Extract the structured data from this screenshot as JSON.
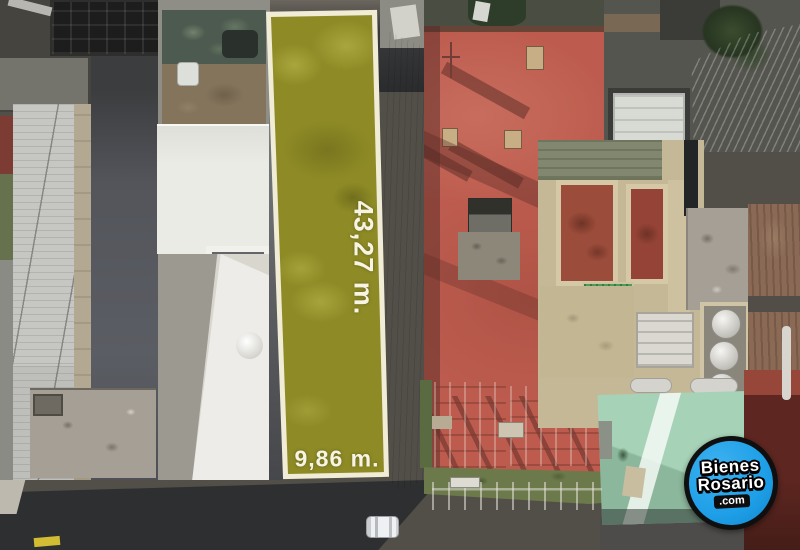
{
  "scene": {
    "description": "Aerial drone photograph of a city block; a long narrow vacant lot is highlighted with a yellow-green overlay between rooftops, street at the bottom",
    "watermark": "BienesRosario.com real-estate badge"
  },
  "lot": {
    "depth_label": "43,27 m.",
    "width_label": "9,86 m."
  },
  "logo": {
    "line1": "Bienes",
    "line2": "Rosario",
    "line3": ".com"
  },
  "colors": {
    "lot_overlay": "#8e8b26",
    "lot_border": "#f1ecd6",
    "measurement_text": "#f7f4e4",
    "logo_blue": "#1e9fe7",
    "logo_ring": "#0f0f0f",
    "logo_text": "#ffffff",
    "red_roof": "#bd5c4e",
    "red_roof_shadow": "#5a2c26",
    "courtyard_red": "#9c4c3a",
    "green_parapet": "#6c7a4b",
    "corrugated_green": "#4f9b58",
    "mint_roof": "#a6d3b7",
    "cream_wall": "#c4b896",
    "white_roof": "#ebebe6",
    "gray_roof": "#c6c7c2",
    "dark_roof": "#53555b",
    "street_asphalt": "#333436",
    "maroon_building": "#5e2620",
    "brown_wall": "#8a6a55",
    "tan_concrete": "#a59f95"
  }
}
